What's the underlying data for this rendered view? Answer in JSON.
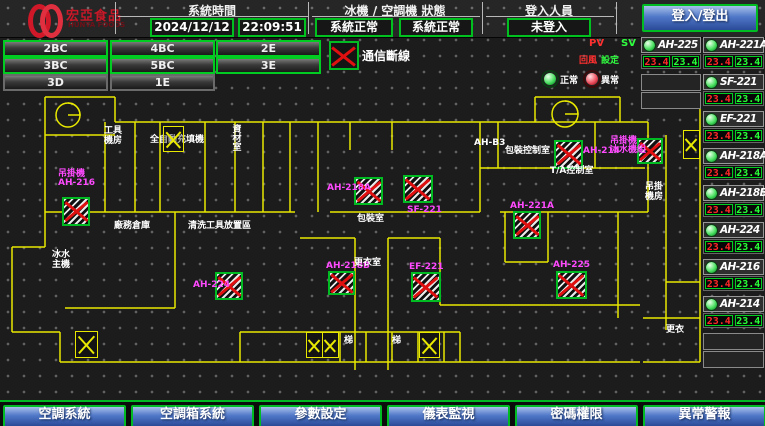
{
  "header": {
    "logo_title": "宏亞食品",
    "logo_subtitle": "HUNYA FOODS",
    "time_section": {
      "label": "系統時間",
      "date": "2024/12/12",
      "time": "22:09:51"
    },
    "status_section": {
      "label": "冰機 / 空調機 狀態",
      "chiller": "系統正常",
      "ahu": "系統正常"
    },
    "login_section": {
      "label": "登入人員",
      "user": "未登入",
      "button_label": "登入/登出"
    }
  },
  "floor_buttons": [
    {
      "label": "2BC",
      "highlighted": true
    },
    {
      "label": "4BC",
      "highlighted": true
    },
    {
      "label": "2E",
      "highlighted": true
    },
    {
      "label": "3BC",
      "highlighted": true
    },
    {
      "label": "5BC",
      "highlighted": true
    },
    {
      "label": "3E",
      "highlighted": true
    },
    {
      "label": "3D",
      "highlighted": false
    },
    {
      "label": "1E",
      "highlighted": false
    }
  ],
  "legend": {
    "comm_loss": "通信斷線",
    "normal": "正常",
    "abnormal": "異常",
    "pv": "PV",
    "sv": "SV",
    "pv_sub": "回風",
    "sv_sub": "設定"
  },
  "units": [
    {
      "name": "AH-225",
      "pv": "23.4",
      "sv": "23.4",
      "status": "normal",
      "column": "A"
    },
    {
      "name": "AH-221A",
      "pv": "23.4",
      "sv": "23.4",
      "status": "normal",
      "column": "B"
    },
    {
      "name": "SF-221",
      "pv": "23.4",
      "sv": "23.4",
      "status": "normal",
      "column": "B"
    },
    {
      "name": "EF-221",
      "pv": "23.4",
      "sv": "23.4",
      "status": "normal",
      "column": "B"
    },
    {
      "name": "AH-218A",
      "pv": "23.4",
      "sv": "23.4",
      "status": "normal",
      "column": "B"
    },
    {
      "name": "AH-218B",
      "pv": "23.4",
      "sv": "23.4",
      "status": "normal",
      "column": "B"
    },
    {
      "name": "AH-224",
      "pv": "23.4",
      "sv": "23.4",
      "status": "normal",
      "column": "B"
    },
    {
      "name": "AH-216",
      "pv": "23.4",
      "sv": "23.4",
      "status": "normal",
      "column": "B"
    },
    {
      "name": "AH-214",
      "pv": "23.4",
      "sv": "23.4",
      "status": "normal",
      "column": "B"
    }
  ],
  "floorplan": {
    "machines": [
      {
        "label": "吊掛機\nAH-216",
        "x": 62,
        "y": 197,
        "w": 28,
        "h": 29,
        "lx": 58,
        "ly": 170
      },
      {
        "label": "AH-224",
        "x": 215,
        "y": 272,
        "w": 28,
        "h": 28,
        "lx": 193,
        "ly": 281
      },
      {
        "label": "AH-218A",
        "x": 354,
        "y": 177,
        "w": 29,
        "h": 28,
        "lx": 327,
        "ly": 184
      },
      {
        "label": "SF-221",
        "x": 403,
        "y": 175,
        "w": 30,
        "h": 28,
        "lx": 407,
        "ly": 206
      },
      {
        "label": "AH-218B",
        "x": 328,
        "y": 271,
        "w": 27,
        "h": 24,
        "lx": 326,
        "ly": 262
      },
      {
        "label": "EF-221",
        "x": 411,
        "y": 272,
        "w": 30,
        "h": 30,
        "lx": 409,
        "ly": 263
      },
      {
        "label": "AH-214",
        "x": 554,
        "y": 140,
        "w": 29,
        "h": 29,
        "lx": 583,
        "ly": 147
      },
      {
        "label": "吊掛機\n冰水機組",
        "x": 637,
        "y": 138,
        "w": 26,
        "h": 26,
        "lx": 610,
        "ly": 137
      },
      {
        "label": "AH-221A",
        "x": 513,
        "y": 211,
        "w": 28,
        "h": 28,
        "lx": 510,
        "ly": 202
      },
      {
        "label": "AH-225",
        "x": 556,
        "y": 271,
        "w": 31,
        "h": 28,
        "lx": 553,
        "ly": 261
      }
    ],
    "rooms": [
      {
        "label": "工具\n機房",
        "x": 104,
        "y": 127
      },
      {
        "label": "全自動充填機",
        "x": 150,
        "y": 136
      },
      {
        "label": "包裝控制室",
        "x": 505,
        "y": 147
      },
      {
        "label": "T/A控制室",
        "x": 550,
        "y": 167
      },
      {
        "label": "AH-B3",
        "x": 474,
        "y": 139
      },
      {
        "label": "包裝室",
        "x": 357,
        "y": 215
      },
      {
        "label": "更衣室",
        "x": 354,
        "y": 259
      },
      {
        "label": "廠務倉庫",
        "x": 114,
        "y": 222
      },
      {
        "label": "清洗工具放置區",
        "x": 188,
        "y": 222
      },
      {
        "label": "冰水\n主機",
        "x": 52,
        "y": 251
      },
      {
        "label": "梯",
        "x": 344,
        "y": 337
      },
      {
        "label": "梯",
        "x": 392,
        "y": 337
      },
      {
        "label": "更衣",
        "x": 666,
        "y": 326
      },
      {
        "label": "吊掛\n機房",
        "x": 645,
        "y": 183
      },
      {
        "label": "資材室",
        "x": 230,
        "y": 124,
        "vertical": true
      }
    ],
    "stairs": [
      {
        "x": 163,
        "y": 126,
        "w": 21,
        "h": 26
      },
      {
        "x": 75,
        "y": 331,
        "w": 23,
        "h": 27
      },
      {
        "x": 306,
        "y": 332,
        "w": 17,
        "h": 26
      },
      {
        "x": 322,
        "y": 332,
        "w": 17,
        "h": 26
      },
      {
        "x": 419,
        "y": 332,
        "w": 21,
        "h": 26
      },
      {
        "x": 683,
        "y": 130,
        "w": 17,
        "h": 29
      }
    ]
  },
  "footer_buttons": [
    "空調系統",
    "空調箱系統",
    "參數設定",
    "儀表監視",
    "密碼權限",
    "異常警報"
  ],
  "colors": {
    "accent_green": "#00cc22",
    "alarm_red": "#e01010",
    "pv_red": "#ff2828",
    "sv_green": "#28ff38",
    "magenta": "#ff4aff",
    "wall_yellow": "#e8e800",
    "button_blue": "#2a4a98",
    "logo_red": "#d01828"
  }
}
